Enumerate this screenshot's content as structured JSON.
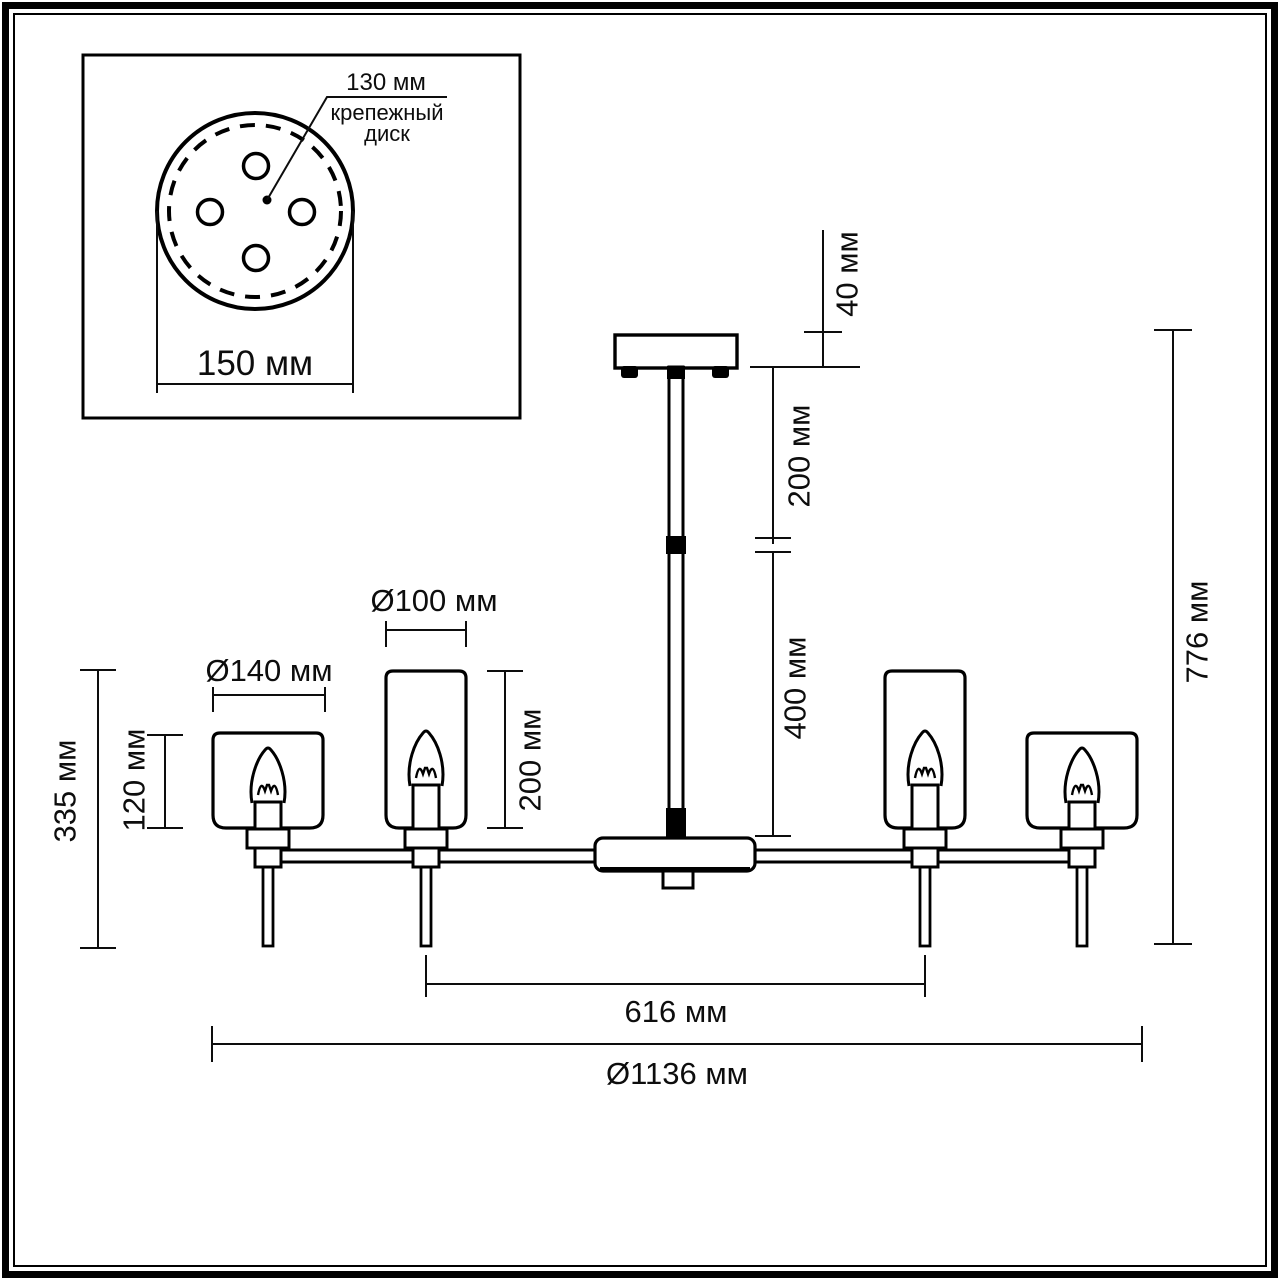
{
  "inset": {
    "disc_diameter_label": "130 мм",
    "disc_name_line1": "крепежный",
    "disc_name_line2": "диск",
    "plate_diameter_label": "150 мм"
  },
  "fixture_dimensions": {
    "canopy_height": "40 мм",
    "upper_rod_length": "200 мм",
    "lower_rod_length": "400 мм",
    "overall_height": "776 мм",
    "inner_shade_diameter": "Ø100 мм",
    "inner_shade_height": "200 мм",
    "outer_shade_diameter": "Ø140 мм",
    "outer_shade_height": "120 мм",
    "arm_lamp_height": "335 мм",
    "inner_lamps_span": "616 мм",
    "overall_diameter": "Ø1136 мм"
  }
}
